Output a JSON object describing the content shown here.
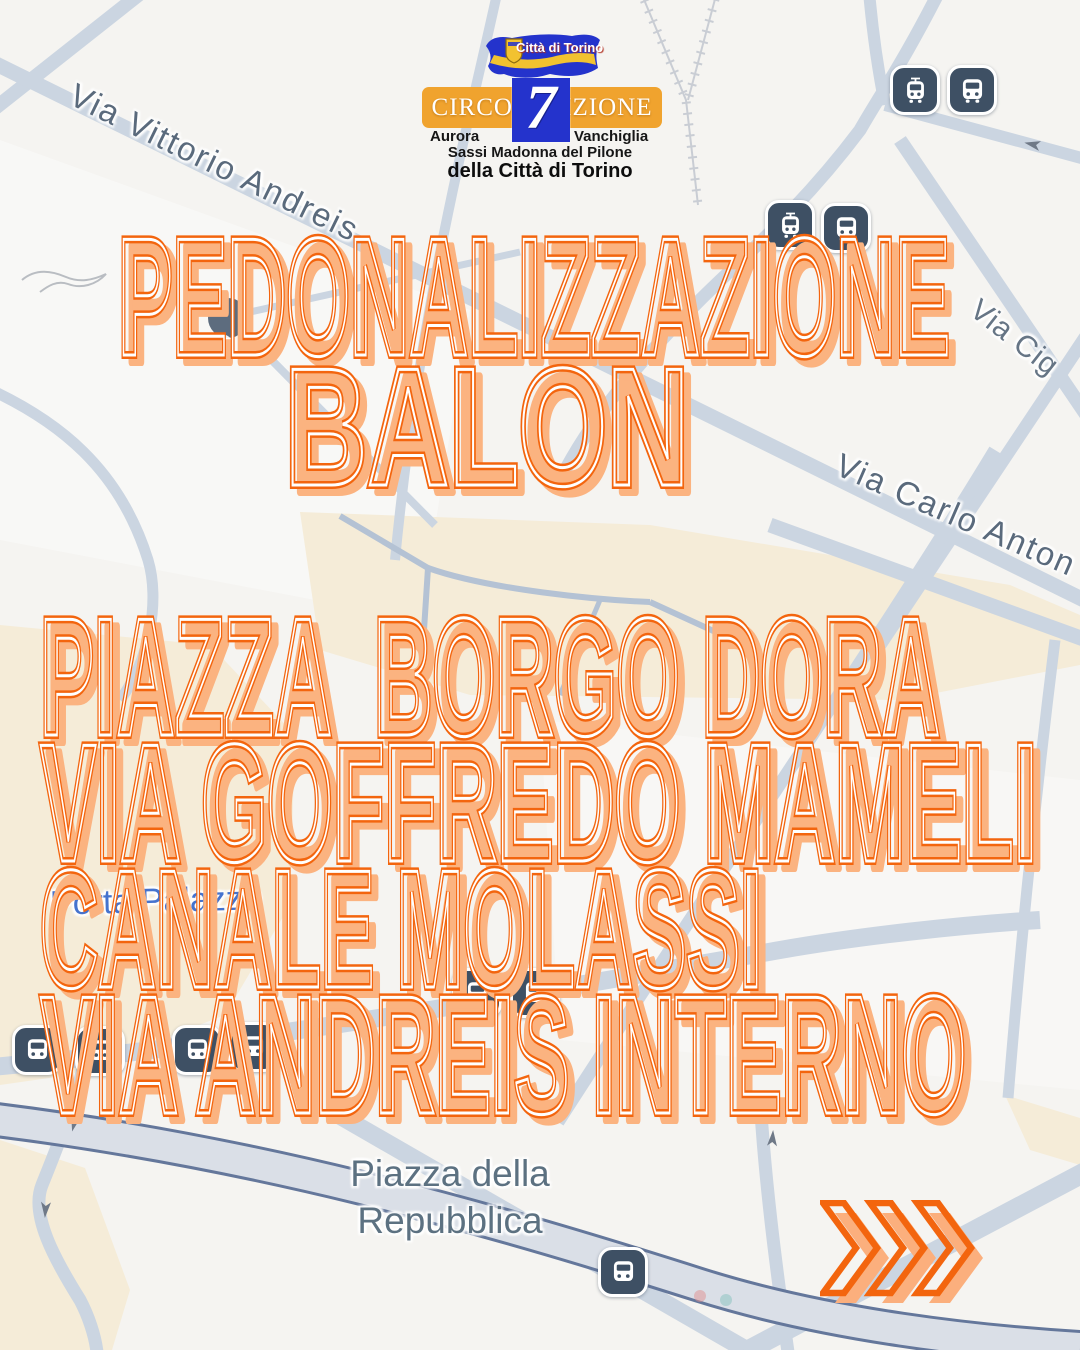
{
  "logo": {
    "flag_text": "Città di Torino",
    "title": "CIRCOSCRIZIONE",
    "number": "7",
    "district_left": "Aurora",
    "district_right": "Vanchiglia",
    "district_center": "Sassi Madonna del Pilone",
    "subtitle": "della Città di Torino"
  },
  "headline": {
    "line1": "PEDONALIZZAZIONE",
    "line2": "BALON"
  },
  "streets": {
    "row1": "PIAZZA  BORGO DORA",
    "row2": "VIA GOFFREDO MAMELI",
    "row3": "CANALE MOLASSI",
    "row4": "VIA ANDREIS INTERNO"
  },
  "map_labels": {
    "andreis": "Via Vittorio Andreis",
    "cigna": "Via Cig",
    "carlo": "Via Carlo Anton",
    "porta": "Porta Palazzo",
    "repubblica": "Piazza della Repubblica"
  },
  "colors": {
    "accent_orange": "#F3650E",
    "accent_peach": "#FBB380",
    "banner_amber": "#F0A32E",
    "flag_blue": "#2433CC",
    "map_background": "#F5F4F1",
    "map_road": "#CBD5E1",
    "map_area_beige": "#F5ECD8",
    "map_label_gray": "#5A6A7C",
    "transit_icon_dark": "#3E5064",
    "porta_palazzo_blue": "#4573CE"
  }
}
